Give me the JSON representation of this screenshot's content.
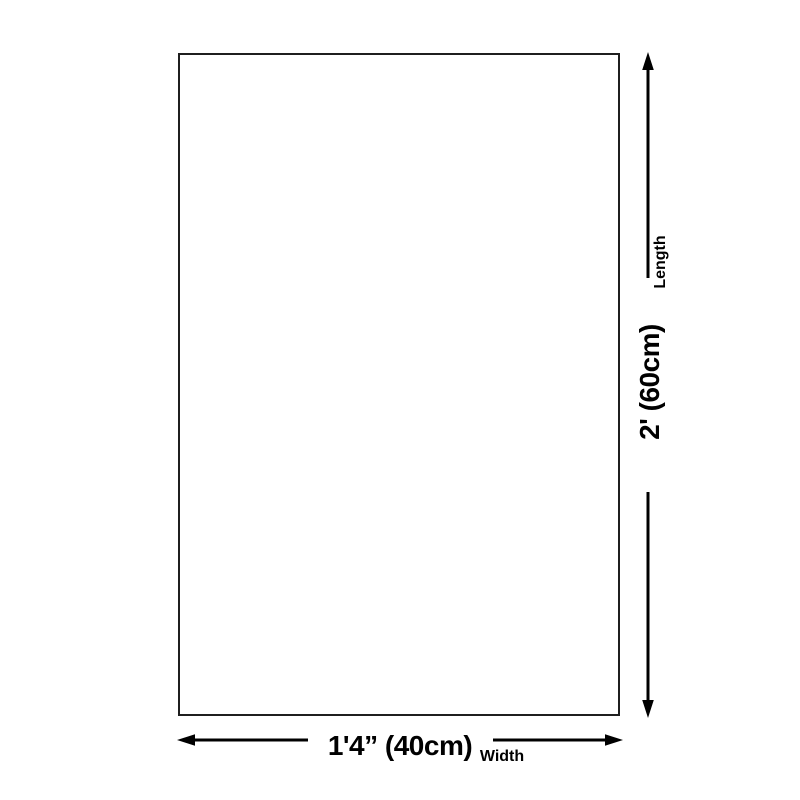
{
  "diagram": {
    "kind": "product-size-diagram",
    "shape": "rectangle-outline",
    "length": {
      "label": "Length",
      "value": "2' (60cm)"
    },
    "width": {
      "label": "Width",
      "value": "1'4” (40cm)"
    }
  },
  "colors": {
    "background": "#ffffff",
    "outline": "#1f1f1f",
    "ink": "#000000"
  }
}
